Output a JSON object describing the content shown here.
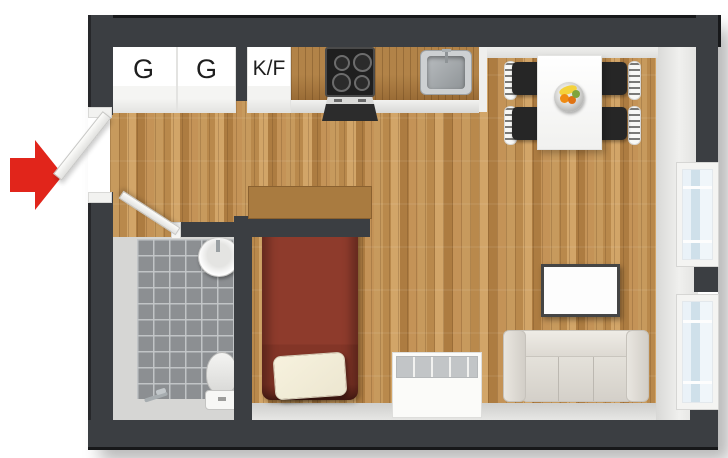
{
  "title": "Studio apartment 3D floor plan",
  "plan": {
    "closets": [
      {
        "label": "G"
      },
      {
        "label": "G"
      }
    ],
    "fridge": {
      "label": "K/F"
    }
  },
  "colors": {
    "wall": "#3b3e42",
    "floor_wood": "#c79a5d",
    "counter_wood": "#b28348",
    "tile": "#8c8f92",
    "bed": "#8e3b2c",
    "pillow": "#ece6d0",
    "rug": "#43312a",
    "sofa": "#dbd7d0",
    "window_glass": "#cfe0ea",
    "arrow_red": "#e1251b"
  },
  "fixtures": [
    "entry-arrow",
    "entry-door",
    "wardrobe",
    "wardrobe",
    "fridge-freezer",
    "kitchen-counter",
    "stove",
    "oven",
    "kitchen-sink",
    "dining-table",
    "dining-chair",
    "fruit-bowl",
    "window",
    "window",
    "rug",
    "tv-panel",
    "sofa",
    "storage-chest",
    "headboard-shelf",
    "bed",
    "pillow",
    "bathroom-door",
    "bathroom-sink",
    "toilet",
    "floor-drain"
  ]
}
